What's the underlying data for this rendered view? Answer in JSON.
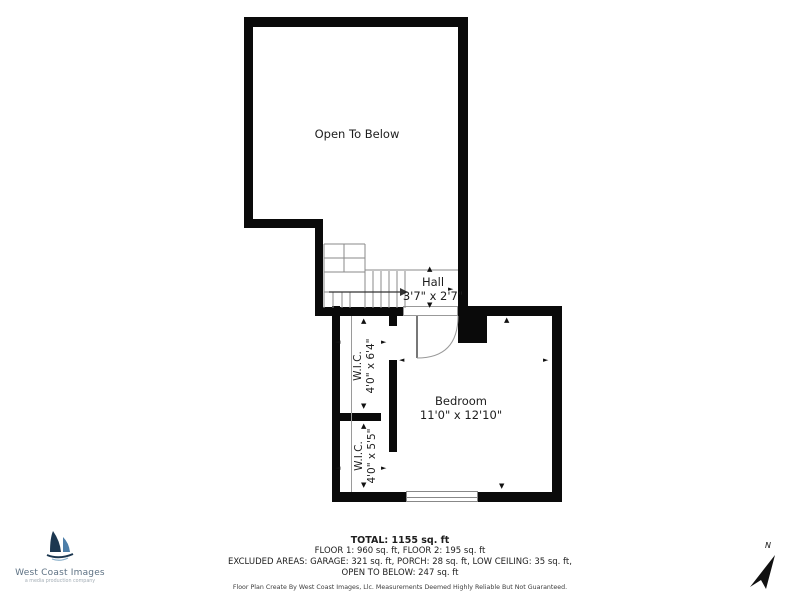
{
  "plan": {
    "rooms": {
      "open_to_below": {
        "label": "Open To Below"
      },
      "hall": {
        "label": "Hall",
        "dimensions": "3'7\" x 2'7\""
      },
      "bedroom": {
        "label": "Bedroom",
        "dimensions": "11'0\" x 12'10\""
      },
      "wic_upper": {
        "label": "W.I.C.",
        "dimensions": "4'0\" x 6'4\""
      },
      "wic_lower": {
        "label": "W.I.C.",
        "dimensions": "4'0\" x 5'5\""
      }
    }
  },
  "summary": {
    "total": "TOTAL: 1155 sq. ft",
    "floors": "FLOOR 1: 960 sq. ft, FLOOR 2: 195 sq. ft",
    "excluded_line1": "EXCLUDED AREAS: GARAGE: 321 sq. ft, PORCH: 28 sq. ft, LOW CEILING: 35 sq. ft,",
    "excluded_line2": "OPEN TO BELOW: 247 sq. ft",
    "disclaimer": "Floor Plan Create By West Coast Images, Llc. Measurements Deemed Highly Reliable But Not Guaranteed."
  },
  "branding": {
    "company": "West Coast Images",
    "tagline": "a media production company"
  },
  "compass": {
    "label": "N"
  },
  "icons": {
    "arrow_up": "▲",
    "arrow_down": "▼",
    "arrow_left": "◄",
    "arrow_right": "►"
  },
  "colors": {
    "wall": "#0a0a0a",
    "thin_line": "#8a8a8a",
    "text": "#1d1d1d",
    "logo_navy": "#1c3750",
    "logo_blue": "#4d7ea8",
    "logo_text": "#5d7183"
  }
}
